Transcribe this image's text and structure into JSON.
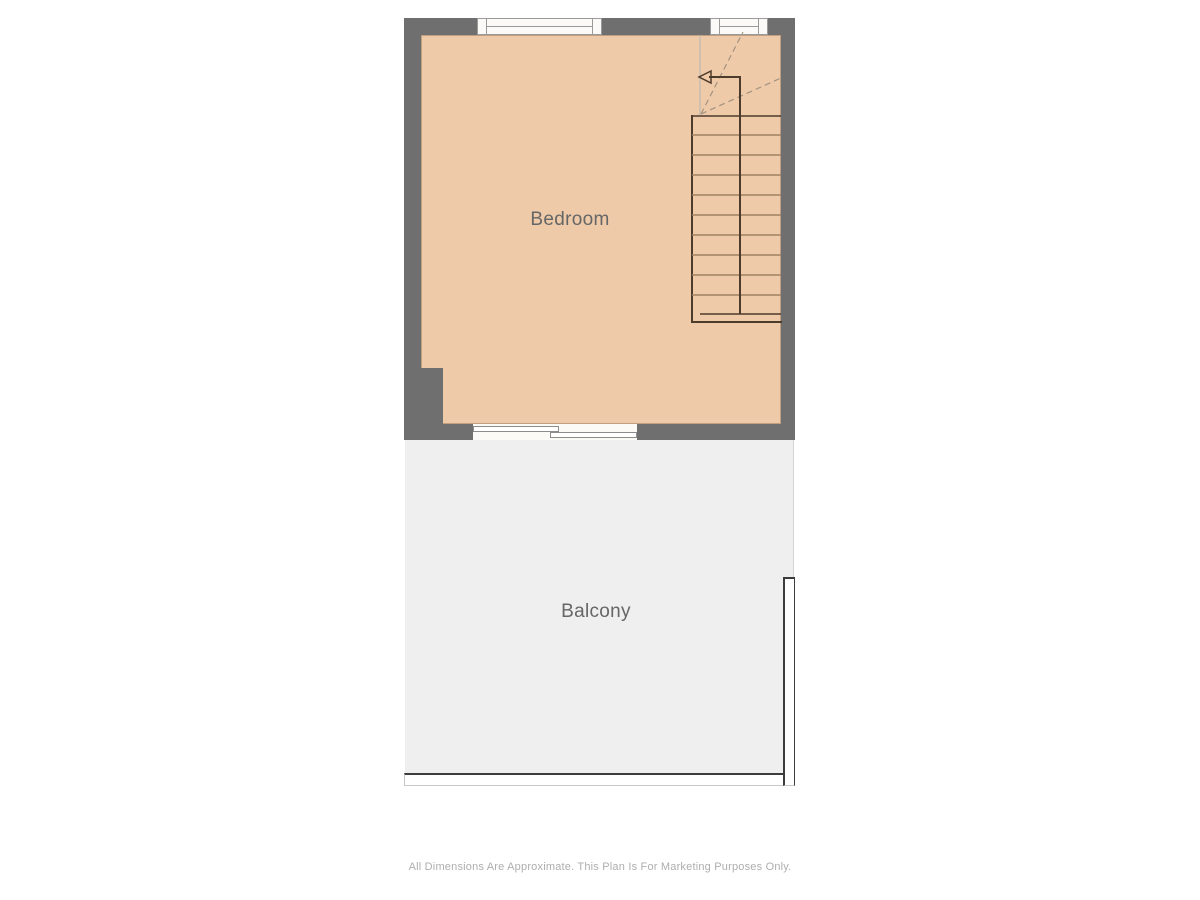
{
  "plan": {
    "rooms": [
      {
        "label": "Bedroom"
      },
      {
        "label": "Balcony"
      }
    ],
    "disclaimer": "All Dimensions Are Approximate. This Plan Is For Marketing Purposes Only.",
    "colors": {
      "wall": "#6f6f6f",
      "bedroom_fill": "#eecaa9",
      "balcony_fill": "#efefef",
      "window_fill": "#fcfaf6",
      "window_frame": "#9a9a9a",
      "door_frame": "#8c8c8c",
      "railing": "#3c3c3c",
      "railing_light": "#c8c8c8",
      "stair_dark": "#4d3b2b",
      "stair_tread": "#9d8164",
      "stair_dashed": "#a3937f",
      "room_label": "#666666",
      "disclaimer": "#aeaeae"
    }
  }
}
